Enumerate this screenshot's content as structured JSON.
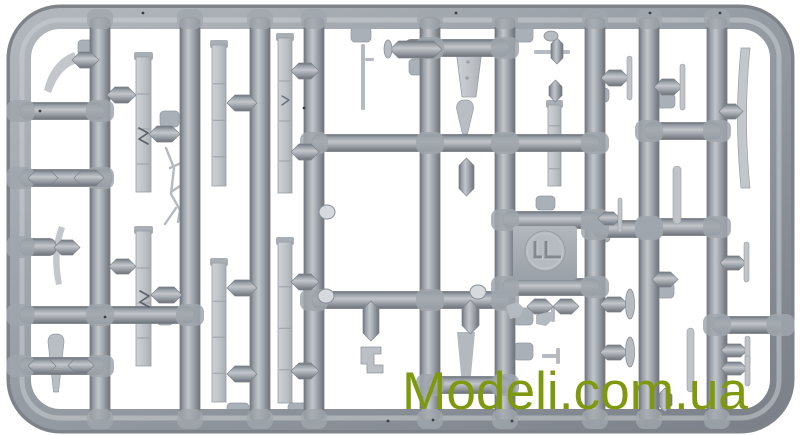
{
  "watermark": {
    "text": "Modeli.com.ua",
    "color": "#7f990f"
  },
  "photo": {
    "background": "#ffffff",
    "subject": "gray plastic model kit sprue with aircraft parts"
  },
  "plastic": {
    "base": "#9aa0a8",
    "light": "#c7cbd0",
    "mid": "#a6abb2",
    "dark": "#6d727a",
    "part": "#c3c7cc",
    "part_edge": "#979da4",
    "pad": "#aab0b7",
    "strip_hi": "#ced1d5",
    "strip_lo": "#a9aeb4",
    "speck": "#3a3f46"
  },
  "sprue": {
    "frame": {
      "x": 20.5,
      "y": 18.5,
      "w": 760,
      "h": 401,
      "rx": 40,
      "t": 21
    },
    "runner_width": 20,
    "runner_y1": 18,
    "runner_y2": 420,
    "runners": [
      100,
      190,
      260,
      314,
      430,
      505,
      595,
      649,
      717
    ],
    "bar_h": 17,
    "bars": [
      {
        "y": 111,
        "x1": 20,
        "x2": 104
      },
      {
        "y": 178,
        "x1": 20,
        "x2": 112
      },
      {
        "y": 247,
        "x1": 20,
        "x2": 56
      },
      {
        "y": 315,
        "x1": 20,
        "x2": 194
      },
      {
        "y": 366,
        "x1": 20,
        "x2": 104
      },
      {
        "y": 48,
        "x1": 404,
        "x2": 509
      },
      {
        "y": 143,
        "x1": 312,
        "x2": 599
      },
      {
        "y": 300,
        "x1": 312,
        "x2": 509
      },
      {
        "y": 220,
        "x1": 503,
        "x2": 599
      },
      {
        "y": 287,
        "x1": 503,
        "x2": 599
      },
      {
        "y": 229,
        "x1": 593,
        "x2": 653
      },
      {
        "y": 131,
        "x1": 645,
        "x2": 721
      },
      {
        "y": 227,
        "x1": 645,
        "x2": 721
      },
      {
        "y": 325,
        "x1": 713,
        "x2": 782
      },
      {
        "y": 385,
        "x1": 428,
        "x2": 509
      }
    ],
    "strips": [
      [
        136,
        52,
        15,
        140
      ],
      [
        136,
        226,
        15,
        140
      ],
      [
        212,
        40,
        14,
        146
      ],
      [
        212,
        258,
        14,
        144
      ],
      [
        278,
        33,
        14,
        160
      ],
      [
        278,
        237,
        14,
        166
      ],
      [
        548,
        100,
        13,
        86
      ]
    ],
    "blades": [
      [
        741,
        48,
        9,
        140,
        -7
      ]
    ],
    "teardrops": [
      [
        56,
        334,
        8,
        58
      ],
      [
        465,
        100,
        8.5,
        34
      ]
    ],
    "trapezoids": [
      [
        455,
        42,
        28,
        55
      ]
    ],
    "rods": [
      [
        361,
        44,
        4,
        66
      ]
    ],
    "stubs": [
      [
        365,
        58,
        9,
        3
      ],
      [
        534,
        50,
        36,
        4
      ],
      [
        537,
        312,
        16,
        4
      ],
      [
        551,
        306,
        4,
        16
      ],
      [
        542,
        354,
        16,
        4
      ],
      [
        556,
        348,
        4,
        16
      ]
    ],
    "pads": [
      [
        78,
        40,
        22,
        16
      ],
      [
        160,
        111,
        19,
        16
      ],
      [
        157,
        311,
        16,
        14
      ],
      [
        227,
        403,
        22,
        14
      ],
      [
        288,
        403,
        20,
        14
      ],
      [
        351,
        27,
        20,
        15
      ],
      [
        409,
        59,
        20,
        16
      ],
      [
        514,
        20,
        19,
        22
      ],
      [
        536,
        196,
        19,
        14
      ],
      [
        514,
        308,
        19,
        17
      ],
      [
        514,
        343,
        19,
        17
      ],
      [
        590,
        88,
        19,
        14
      ],
      [
        592,
        228,
        18,
        14
      ],
      [
        655,
        94,
        20,
        14
      ],
      [
        654,
        283,
        20,
        15
      ]
    ],
    "hcapsules": [
      [
        72,
        52,
        27,
        16
      ],
      [
        28,
        170,
        30,
        16
      ],
      [
        74,
        170,
        30,
        16
      ],
      [
        54,
        240,
        26,
        15
      ],
      [
        28,
        358,
        28,
        16
      ],
      [
        68,
        358,
        26,
        15
      ],
      [
        107,
        87,
        29,
        16
      ],
      [
        149,
        126,
        31,
        16
      ],
      [
        109,
        259,
        27,
        15
      ],
      [
        151,
        287,
        31,
        16
      ],
      [
        227,
        95,
        30,
        16
      ],
      [
        227,
        280,
        30,
        16
      ],
      [
        227,
        366,
        30,
        16
      ],
      [
        291,
        63,
        28,
        16
      ],
      [
        291,
        144,
        28,
        16
      ],
      [
        291,
        274,
        28,
        16
      ],
      [
        291,
        363,
        28,
        16
      ],
      [
        390,
        41,
        52,
        17
      ],
      [
        719,
        104,
        24,
        15
      ],
      [
        720,
        256,
        26,
        14
      ],
      [
        721,
        344,
        26,
        13
      ],
      [
        721,
        362,
        26,
        13
      ],
      [
        601,
        70,
        28,
        16
      ],
      [
        654,
        79,
        28,
        16
      ],
      [
        598,
        212,
        22,
        13
      ],
      [
        600,
        297,
        28,
        15
      ],
      [
        600,
        345,
        28,
        15
      ],
      [
        652,
        272,
        26,
        15
      ],
      [
        527,
        299,
        26,
        15
      ],
      [
        553,
        299,
        26,
        15
      ]
    ],
    "vcapsules": [
      [
        363,
        301,
        16,
        40
      ],
      [
        462,
        300,
        17,
        34
      ],
      [
        459,
        158,
        15,
        38
      ],
      [
        549,
        80,
        13,
        22
      ],
      [
        551,
        38,
        12,
        26
      ],
      [
        658,
        388,
        14,
        24
      ]
    ],
    "vblades": [
      [
        627,
        56,
        5,
        44
      ],
      [
        680,
        64,
        5,
        46
      ],
      [
        618,
        198,
        4,
        34
      ],
      [
        744,
        242,
        5,
        40
      ],
      [
        745,
        336,
        5,
        30
      ],
      [
        745,
        356,
        5,
        30
      ],
      [
        687,
        328,
        7,
        64
      ],
      [
        673,
        166,
        8,
        58
      ]
    ],
    "ellipses": [
      [
        388,
        49,
        4,
        9
      ],
      [
        630,
        304,
        4.5,
        15
      ],
      [
        630,
        352,
        4.5,
        15
      ],
      [
        551,
        36,
        7,
        5
      ]
    ],
    "nubs": [
      [
        327,
        212
      ],
      [
        326,
        296
      ],
      [
        478,
        292
      ]
    ],
    "specks": [
      [
        143,
        13
      ],
      [
        40,
        111
      ],
      [
        304,
        108
      ],
      [
        456,
        13
      ],
      [
        650,
        13
      ],
      [
        433,
        420
      ],
      [
        512,
        421
      ],
      [
        720,
        13
      ],
      [
        105,
        317
      ],
      [
        388,
        421
      ]
    ],
    "plate": {
      "x": 513,
      "y": 226,
      "w": 64,
      "h": 54
    },
    "logo_disc": {
      "cx": 545,
      "cy": 251,
      "r": 20,
      "mark_d": "M535,241 v16 h7 M546,241 v16 h15"
    },
    "paths_under": [
      {
        "name": "part-strut-wire",
        "d": "M166,148 l8,20 l-3,26 l9,16 l-2,12 M171,192 l12,-8 M170,168 l13,-6 M176,208 l-11,16",
        "stroke": "#b6bac0",
        "w": 2.4
      },
      {
        "name": "part-float-tail",
        "d": "M457,332 h18 l-5,54 h-8 Z",
        "fill": "#b4b9bf"
      },
      {
        "name": "part-prop-blade-curved",
        "d": "M74,52 Q51,61 44,90 L51,93 Q60,67 78,63 Z",
        "fill": "#c3c7cc"
      },
      {
        "name": "part-blade-curved",
        "d": "M59,226 Q49,253 56,285 L62,284 Q56,253 65,228 Z",
        "fill": "#c3c7cc"
      }
    ],
    "paths_over": [
      {
        "name": "strip-notch-mark",
        "d": "M139,128 l9,5 l-9,6 l9,5",
        "stroke": "#5a6068",
        "w": 1.6
      },
      {
        "name": "strip-notch-mark",
        "d": "M140,291 l9,5 l-9,6 l9,5",
        "stroke": "#5a6068",
        "w": 1.6
      },
      {
        "name": "strip-notch-mark",
        "d": "M282,96 l7,4 l-7,5",
        "stroke": "#6a7078",
        "w": 1.4
      },
      {
        "name": "part-bracket",
        "d": "M361,347 h20 v7 h-7 v11 h9 v8 h-16 v-9 h-6 Z",
        "fill": "#bcc0c6",
        "stroke": "#8f959c",
        "w": 0.8
      },
      {
        "name": "part-small-bit",
        "d": "M506,306 l11,-4 l7,6 l-4,9 l-10,2 Z",
        "fill": "#b5bac1"
      },
      {
        "name": "part-small-bit",
        "d": "M536,315 l12,-3 l5,7 l-7,7 l-10,-2 Z",
        "fill": "#b5bac1"
      }
    ]
  }
}
